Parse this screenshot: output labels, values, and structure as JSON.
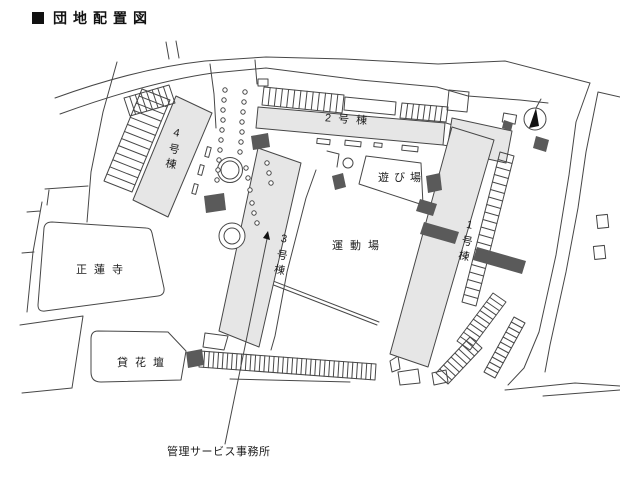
{
  "title": {
    "bullet": "■",
    "text": "団地配置図"
  },
  "map": {
    "labels": {
      "building1": "1号棟",
      "building2": "2号棟",
      "building3": "3号棟",
      "building4": "4号棟",
      "sports_ground": "運動場",
      "playground": "遊び場",
      "temple": "正蓮寺",
      "flower_bed": "貸花壇",
      "office": "管理サービス事務所"
    },
    "icons": {
      "north_arrow": "compass-north-arrow"
    },
    "colors": {
      "line": "#474747",
      "building_fill": "#e6e6e6",
      "hatch_dark": "#5a5a5a",
      "north_arrow_fill": "#111111",
      "background": "#ffffff",
      "text": "#1c1c1c"
    }
  }
}
